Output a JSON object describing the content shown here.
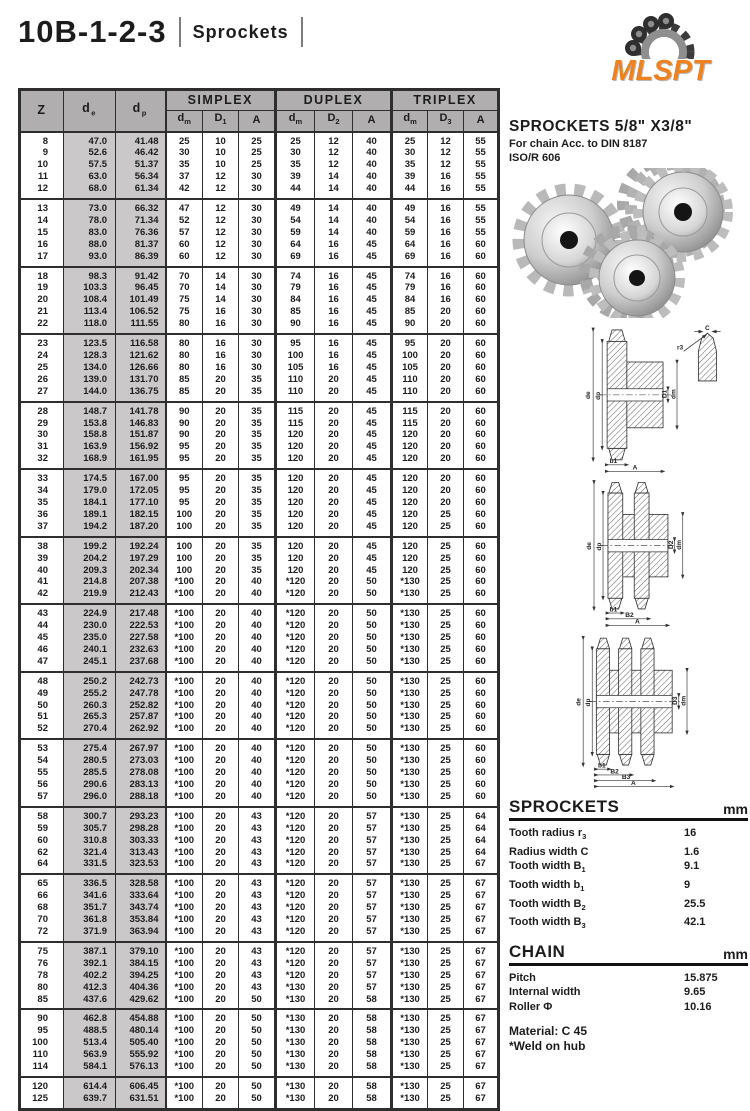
{
  "header": {
    "title": "10B-1-2-3",
    "subtitle": "Sprockets",
    "logo_text": "MLSPT",
    "logo_color": "#ee8120"
  },
  "product": {
    "heading": "SPROCKETS 5/8\" X3/8\"",
    "line1": "For chain Acc. to DIN 8187",
    "line2": "ISO/R 606"
  },
  "table": {
    "groups": [
      "SIMPLEX",
      "DUPLEX",
      "TRIPLEX"
    ],
    "col_z": "Z",
    "col_de": {
      "base": "d",
      "sub": "e"
    },
    "col_dp": {
      "base": "d",
      "sub": "p"
    },
    "sub_headers": [
      {
        "base": "d",
        "sub": "m"
      },
      {
        "base": "D",
        "sub": "1"
      },
      {
        "base": "A",
        "sub": ""
      },
      {
        "base": "d",
        "sub": "m"
      },
      {
        "base": "D",
        "sub": "2"
      },
      {
        "base": "A",
        "sub": ""
      },
      {
        "base": "d",
        "sub": "m"
      },
      {
        "base": "D",
        "sub": "3"
      },
      {
        "base": "A",
        "sub": ""
      }
    ],
    "blocks": [
      [
        [
          "8",
          "47.0",
          "41.48",
          "25",
          "10",
          "25",
          "25",
          "12",
          "40",
          "25",
          "12",
          "55"
        ],
        [
          "9",
          "52.6",
          "46.42",
          "30",
          "10",
          "25",
          "30",
          "12",
          "40",
          "30",
          "12",
          "55"
        ],
        [
          "10",
          "57.5",
          "51.37",
          "35",
          "10",
          "25",
          "35",
          "12",
          "40",
          "35",
          "12",
          "55"
        ],
        [
          "11",
          "63.0",
          "56.34",
          "37",
          "12",
          "30",
          "39",
          "14",
          "40",
          "39",
          "16",
          "55"
        ],
        [
          "12",
          "68.0",
          "61.34",
          "42",
          "12",
          "30",
          "44",
          "14",
          "40",
          "44",
          "16",
          "55"
        ]
      ],
      [
        [
          "13",
          "73.0",
          "66.32",
          "47",
          "12",
          "30",
          "49",
          "14",
          "40",
          "49",
          "16",
          "55"
        ],
        [
          "14",
          "78.0",
          "71.34",
          "52",
          "12",
          "30",
          "54",
          "14",
          "40",
          "54",
          "16",
          "55"
        ],
        [
          "15",
          "83.0",
          "76.36",
          "57",
          "12",
          "30",
          "59",
          "14",
          "40",
          "59",
          "16",
          "55"
        ],
        [
          "16",
          "88.0",
          "81.37",
          "60",
          "12",
          "30",
          "64",
          "16",
          "45",
          "64",
          "16",
          "60"
        ],
        [
          "17",
          "93.0",
          "86.39",
          "60",
          "12",
          "30",
          "69",
          "16",
          "45",
          "69",
          "16",
          "60"
        ]
      ],
      [
        [
          "18",
          "98.3",
          "91.42",
          "70",
          "14",
          "30",
          "74",
          "16",
          "45",
          "74",
          "16",
          "60"
        ],
        [
          "19",
          "103.3",
          "96.45",
          "70",
          "14",
          "30",
          "79",
          "16",
          "45",
          "79",
          "16",
          "60"
        ],
        [
          "20",
          "108.4",
          "101.49",
          "75",
          "14",
          "30",
          "84",
          "16",
          "45",
          "84",
          "16",
          "60"
        ],
        [
          "21",
          "113.4",
          "106.52",
          "75",
          "16",
          "30",
          "85",
          "16",
          "45",
          "85",
          "20",
          "60"
        ],
        [
          "22",
          "118.0",
          "111.55",
          "80",
          "16",
          "30",
          "90",
          "16",
          "45",
          "90",
          "20",
          "60"
        ]
      ],
      [
        [
          "23",
          "123.5",
          "116.58",
          "80",
          "16",
          "30",
          "95",
          "16",
          "45",
          "95",
          "20",
          "60"
        ],
        [
          "24",
          "128.3",
          "121.62",
          "80",
          "16",
          "30",
          "100",
          "16",
          "45",
          "100",
          "20",
          "60"
        ],
        [
          "25",
          "134.0",
          "126.66",
          "80",
          "16",
          "30",
          "105",
          "16",
          "45",
          "105",
          "20",
          "60"
        ],
        [
          "26",
          "139.0",
          "131.70",
          "85",
          "20",
          "35",
          "110",
          "20",
          "45",
          "110",
          "20",
          "60"
        ],
        [
          "27",
          "144.0",
          "136.75",
          "85",
          "20",
          "35",
          "110",
          "20",
          "45",
          "110",
          "20",
          "60"
        ]
      ],
      [
        [
          "28",
          "148.7",
          "141.78",
          "90",
          "20",
          "35",
          "115",
          "20",
          "45",
          "115",
          "20",
          "60"
        ],
        [
          "29",
          "153.8",
          "146.83",
          "90",
          "20",
          "35",
          "115",
          "20",
          "45",
          "115",
          "20",
          "60"
        ],
        [
          "30",
          "158.8",
          "151.87",
          "90",
          "20",
          "35",
          "120",
          "20",
          "45",
          "120",
          "20",
          "60"
        ],
        [
          "31",
          "163.9",
          "156.92",
          "95",
          "20",
          "35",
          "120",
          "20",
          "45",
          "120",
          "20",
          "60"
        ],
        [
          "32",
          "168.9",
          "161.95",
          "95",
          "20",
          "35",
          "120",
          "20",
          "45",
          "120",
          "20",
          "60"
        ]
      ],
      [
        [
          "33",
          "174.5",
          "167.00",
          "95",
          "20",
          "35",
          "120",
          "20",
          "45",
          "120",
          "20",
          "60"
        ],
        [
          "34",
          "179.0",
          "172.05",
          "95",
          "20",
          "35",
          "120",
          "20",
          "45",
          "120",
          "20",
          "60"
        ],
        [
          "35",
          "184.1",
          "177.10",
          "95",
          "20",
          "35",
          "120",
          "20",
          "45",
          "120",
          "20",
          "60"
        ],
        [
          "36",
          "189.1",
          "182.15",
          "100",
          "20",
          "35",
          "120",
          "20",
          "45",
          "120",
          "25",
          "60"
        ],
        [
          "37",
          "194.2",
          "187.20",
          "100",
          "20",
          "35",
          "120",
          "20",
          "45",
          "120",
          "25",
          "60"
        ]
      ],
      [
        [
          "38",
          "199.2",
          "192.24",
          "100",
          "20",
          "35",
          "120",
          "20",
          "45",
          "120",
          "25",
          "60"
        ],
        [
          "39",
          "204.2",
          "197.29",
          "100",
          "20",
          "35",
          "120",
          "20",
          "45",
          "120",
          "25",
          "60"
        ],
        [
          "40",
          "209.3",
          "202.34",
          "100",
          "20",
          "35",
          "120",
          "20",
          "45",
          "120",
          "25",
          "60"
        ],
        [
          "41",
          "214.8",
          "207.38",
          "*100",
          "20",
          "40",
          "*120",
          "20",
          "50",
          "*130",
          "25",
          "60"
        ],
        [
          "42",
          "219.9",
          "212.43",
          "*100",
          "20",
          "40",
          "*120",
          "20",
          "50",
          "*130",
          "25",
          "60"
        ]
      ],
      [
        [
          "43",
          "224.9",
          "217.48",
          "*100",
          "20",
          "40",
          "*120",
          "20",
          "50",
          "*130",
          "25",
          "60"
        ],
        [
          "44",
          "230.0",
          "222.53",
          "*100",
          "20",
          "40",
          "*120",
          "20",
          "50",
          "*130",
          "25",
          "60"
        ],
        [
          "45",
          "235.0",
          "227.58",
          "*100",
          "20",
          "40",
          "*120",
          "20",
          "50",
          "*130",
          "25",
          "60"
        ],
        [
          "46",
          "240.1",
          "232.63",
          "*100",
          "20",
          "40",
          "*120",
          "20",
          "50",
          "*130",
          "25",
          "60"
        ],
        [
          "47",
          "245.1",
          "237.68",
          "*100",
          "20",
          "40",
          "*120",
          "20",
          "50",
          "*130",
          "25",
          "60"
        ]
      ],
      [
        [
          "48",
          "250.2",
          "242.73",
          "*100",
          "20",
          "40",
          "*120",
          "20",
          "50",
          "*130",
          "25",
          "60"
        ],
        [
          "49",
          "255.2",
          "247.78",
          "*100",
          "20",
          "40",
          "*120",
          "20",
          "50",
          "*130",
          "25",
          "60"
        ],
        [
          "50",
          "260.3",
          "252.82",
          "*100",
          "20",
          "40",
          "*120",
          "20",
          "50",
          "*130",
          "25",
          "60"
        ],
        [
          "51",
          "265.3",
          "257.87",
          "*100",
          "20",
          "40",
          "*120",
          "20",
          "50",
          "*130",
          "25",
          "60"
        ],
        [
          "52",
          "270.4",
          "262.92",
          "*100",
          "20",
          "40",
          "*120",
          "20",
          "50",
          "*130",
          "25",
          "60"
        ]
      ],
      [
        [
          "53",
          "275.4",
          "267.97",
          "*100",
          "20",
          "40",
          "*120",
          "20",
          "50",
          "*130",
          "25",
          "60"
        ],
        [
          "54",
          "280.5",
          "273.03",
          "*100",
          "20",
          "40",
          "*120",
          "20",
          "50",
          "*130",
          "25",
          "60"
        ],
        [
          "55",
          "285.5",
          "278.08",
          "*100",
          "20",
          "40",
          "*120",
          "20",
          "50",
          "*130",
          "25",
          "60"
        ],
        [
          "56",
          "290.6",
          "283.13",
          "*100",
          "20",
          "40",
          "*120",
          "20",
          "50",
          "*130",
          "25",
          "60"
        ],
        [
          "57",
          "296.0",
          "288.18",
          "*100",
          "20",
          "40",
          "*120",
          "20",
          "50",
          "*130",
          "25",
          "60"
        ]
      ],
      [
        [
          "58",
          "300.7",
          "293.23",
          "*100",
          "20",
          "43",
          "*120",
          "20",
          "57",
          "*130",
          "25",
          "64"
        ],
        [
          "59",
          "305.7",
          "298.28",
          "*100",
          "20",
          "43",
          "*120",
          "20",
          "57",
          "*130",
          "25",
          "64"
        ],
        [
          "60",
          "310.8",
          "303.33",
          "*100",
          "20",
          "43",
          "*120",
          "20",
          "57",
          "*130",
          "25",
          "64"
        ],
        [
          "62",
          "321.4",
          "313.43",
          "*100",
          "20",
          "43",
          "*120",
          "20",
          "57",
          "*130",
          "25",
          "64"
        ],
        [
          "64",
          "331.5",
          "323.53",
          "*100",
          "20",
          "43",
          "*120",
          "20",
          "57",
          "*130",
          "25",
          "67"
        ]
      ],
      [
        [
          "65",
          "336.5",
          "328.58",
          "*100",
          "20",
          "43",
          "*120",
          "20",
          "57",
          "*130",
          "25",
          "67"
        ],
        [
          "66",
          "341.6",
          "333.64",
          "*100",
          "20",
          "43",
          "*120",
          "20",
          "57",
          "*130",
          "25",
          "67"
        ],
        [
          "68",
          "351.7",
          "343.74",
          "*100",
          "20",
          "43",
          "*120",
          "20",
          "57",
          "*130",
          "25",
          "67"
        ],
        [
          "70",
          "361.8",
          "353.84",
          "*100",
          "20",
          "43",
          "*120",
          "20",
          "57",
          "*130",
          "25",
          "67"
        ],
        [
          "72",
          "371.9",
          "363.94",
          "*100",
          "20",
          "43",
          "*120",
          "20",
          "57",
          "*130",
          "25",
          "67"
        ]
      ],
      [
        [
          "75",
          "387.1",
          "379.10",
          "*100",
          "20",
          "43",
          "*120",
          "20",
          "57",
          "*130",
          "25",
          "67"
        ],
        [
          "76",
          "392.1",
          "384.15",
          "*100",
          "20",
          "43",
          "*120",
          "20",
          "57",
          "*130",
          "25",
          "67"
        ],
        [
          "78",
          "402.2",
          "394.25",
          "*100",
          "20",
          "43",
          "*120",
          "20",
          "57",
          "*130",
          "25",
          "67"
        ],
        [
          "80",
          "412.3",
          "404.36",
          "*100",
          "20",
          "43",
          "*130",
          "20",
          "57",
          "*130",
          "25",
          "67"
        ],
        [
          "85",
          "437.6",
          "429.62",
          "*100",
          "20",
          "50",
          "*130",
          "20",
          "58",
          "*130",
          "25",
          "67"
        ]
      ],
      [
        [
          "90",
          "462.8",
          "454.88",
          "*100",
          "20",
          "50",
          "*130",
          "20",
          "58",
          "*130",
          "25",
          "67"
        ],
        [
          "95",
          "488.5",
          "480.14",
          "*100",
          "20",
          "50",
          "*130",
          "20",
          "58",
          "*130",
          "25",
          "67"
        ],
        [
          "100",
          "513.4",
          "505.40",
          "*100",
          "20",
          "50",
          "*130",
          "20",
          "58",
          "*130",
          "25",
          "67"
        ],
        [
          "110",
          "563.9",
          "555.92",
          "*100",
          "20",
          "50",
          "*130",
          "20",
          "58",
          "*130",
          "25",
          "67"
        ],
        [
          "114",
          "584.1",
          "576.13",
          "*100",
          "20",
          "50",
          "*130",
          "20",
          "58",
          "*130",
          "25",
          "67"
        ]
      ],
      [
        [
          "120",
          "614.4",
          "606.45",
          "*100",
          "20",
          "50",
          "*130",
          "20",
          "58",
          "*130",
          "25",
          "67"
        ],
        [
          "125",
          "639.7",
          "631.51",
          "*100",
          "20",
          "50",
          "*130",
          "20",
          "58",
          "*130",
          "25",
          "67"
        ]
      ]
    ]
  },
  "diagrams": {
    "tooth_detail": {
      "c": "C",
      "r3": "r3"
    },
    "simplex": {
      "de": "de",
      "dp": "dp",
      "d1": "D1",
      "dm": "dm",
      "b1": "b1",
      "a": "A"
    },
    "duplex": {
      "de": "de",
      "dp": "dp",
      "d2": "D2",
      "dm": "dm",
      "b1": "b1",
      "b2": "B2",
      "a": "A"
    },
    "triplex": {
      "de": "de",
      "dp": "dp",
      "d3": "D3",
      "dm": "dm",
      "b1": "b1",
      "b2": "B2",
      "b3": "B3",
      "a": "A"
    }
  },
  "specs": {
    "sprockets": {
      "heading": "SPROCKETS",
      "unit": "mm",
      "rows": [
        {
          "label": "Tooth radius r",
          "sub": "3",
          "value": "16"
        },
        {
          "label": "Radius width C",
          "sub": "",
          "value": "1.6"
        },
        {
          "label": "Tooth width B",
          "sub": "1",
          "value": "9.1"
        },
        {
          "label": "Tooth width b",
          "sub": "1",
          "value": "9"
        },
        {
          "label": "Tooth width B",
          "sub": "2",
          "value": "25.5"
        },
        {
          "label": "Tooth width B",
          "sub": "3",
          "value": "42.1"
        }
      ]
    },
    "chain": {
      "heading": "CHAIN",
      "unit": "mm",
      "rows": [
        {
          "label": "Pitch",
          "sub": "",
          "value": "15.875"
        },
        {
          "label": "Internal width",
          "sub": "",
          "value": "9.65"
        },
        {
          "label": "Roller Φ",
          "sub": "",
          "value": "10.16"
        }
      ]
    },
    "material": "Material: C 45",
    "weld_note": "*Weld on hub"
  },
  "colors": {
    "header_bg": "#b0aeae",
    "shaded_column": "#cac8c8",
    "border": "#2e2e2e",
    "logo_orange": "#ee8120"
  }
}
